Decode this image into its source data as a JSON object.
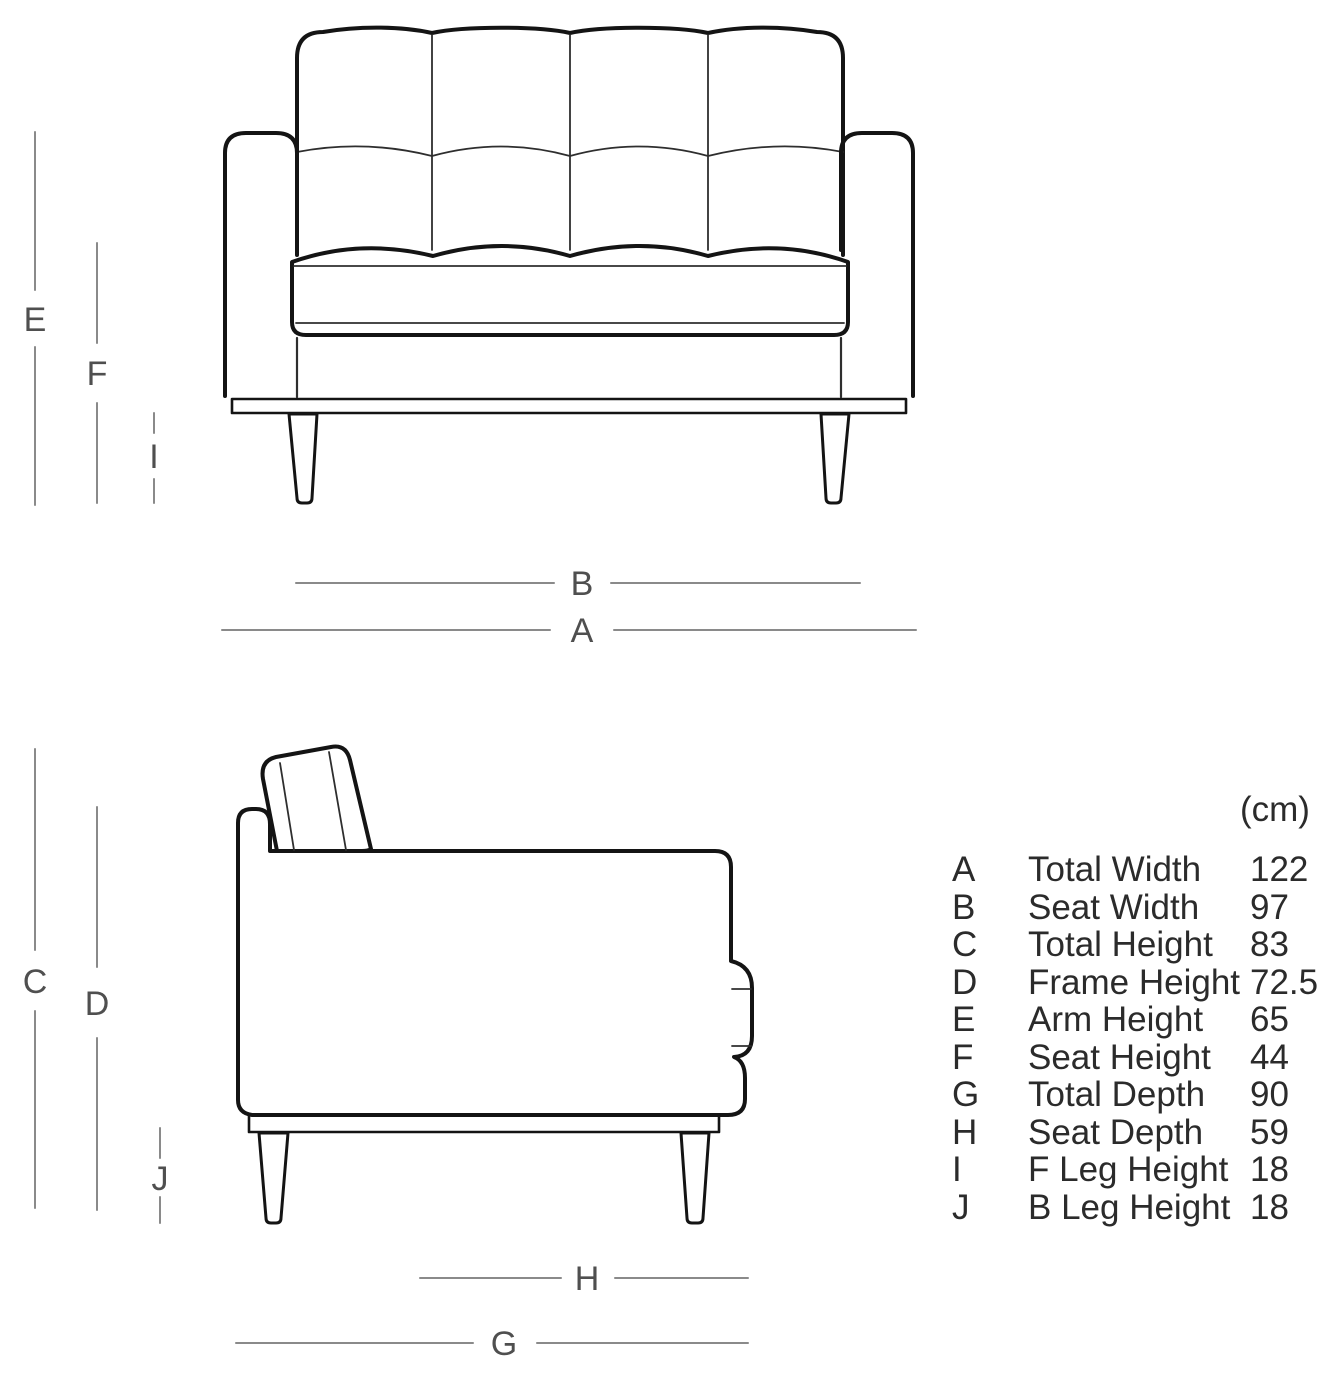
{
  "units_label": "(cm)",
  "table": {
    "rows": [
      {
        "letter": "A",
        "name": "Total Width",
        "value": "122"
      },
      {
        "letter": "B",
        "name": "Seat Width",
        "value": "97"
      },
      {
        "letter": "C",
        "name": "Total Height",
        "value": "83"
      },
      {
        "letter": "D",
        "name": "Frame Height",
        "value": "72.5"
      },
      {
        "letter": "E",
        "name": "Arm Height",
        "value": "65"
      },
      {
        "letter": "F",
        "name": "Seat Height",
        "value": "44"
      },
      {
        "letter": "G",
        "name": "Total Depth",
        "value": "90"
      },
      {
        "letter": "H",
        "name": "Seat Depth",
        "value": "59"
      },
      {
        "letter": "I",
        "name": "F Leg Height",
        "value": "18"
      },
      {
        "letter": "J",
        "name": "B Leg Height",
        "value": "18"
      }
    ]
  },
  "colors": {
    "outline": "#141414",
    "inner_seam": "#2e2e2e",
    "dimension_line": "#8a8a8a",
    "dimension_label": "#4f4f4f",
    "table_text": "#2b2b2b",
    "background": "#ffffff"
  }
}
